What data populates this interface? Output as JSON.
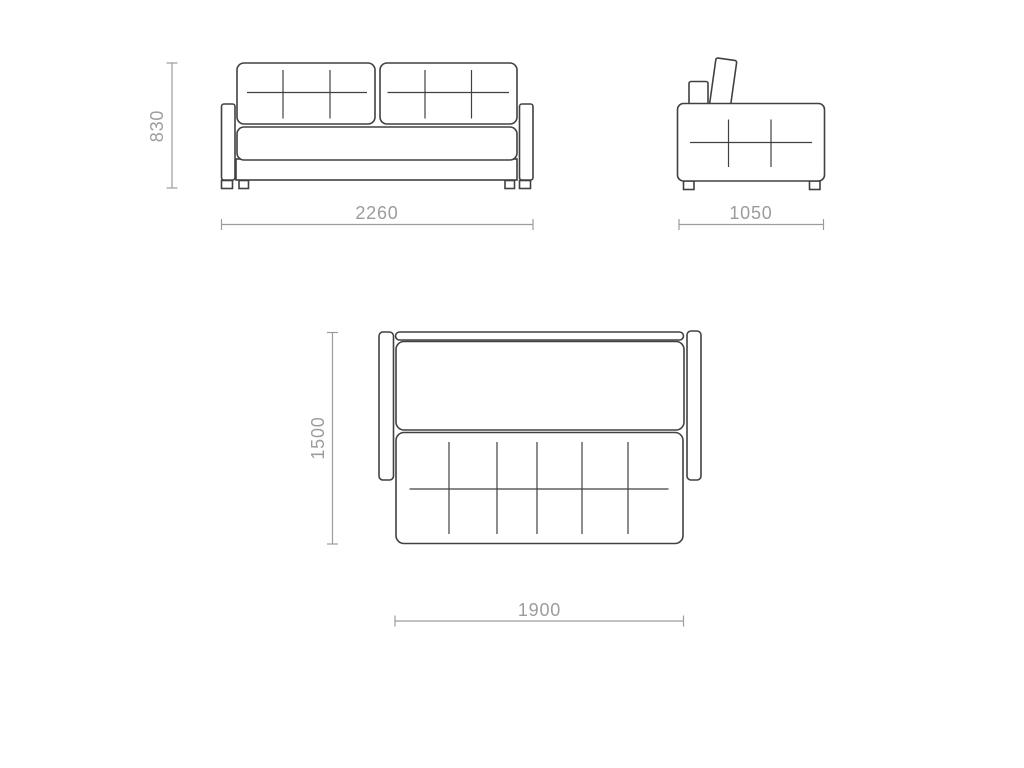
{
  "document": {
    "type": "furniture technical drawing",
    "subject": "sofa-bed with fold-out sleeping surface",
    "background": "#ffffff"
  },
  "palette": {
    "outline_color": "#414141",
    "dimension_color": "#9c9c9c"
  },
  "views": {
    "front": {
      "name": "front view",
      "height": "830",
      "width": "2260"
    },
    "side": {
      "name": "side view",
      "depth": "1050"
    },
    "bed": {
      "name": "unfolded top view",
      "depth": "1500",
      "width": "1900"
    }
  }
}
